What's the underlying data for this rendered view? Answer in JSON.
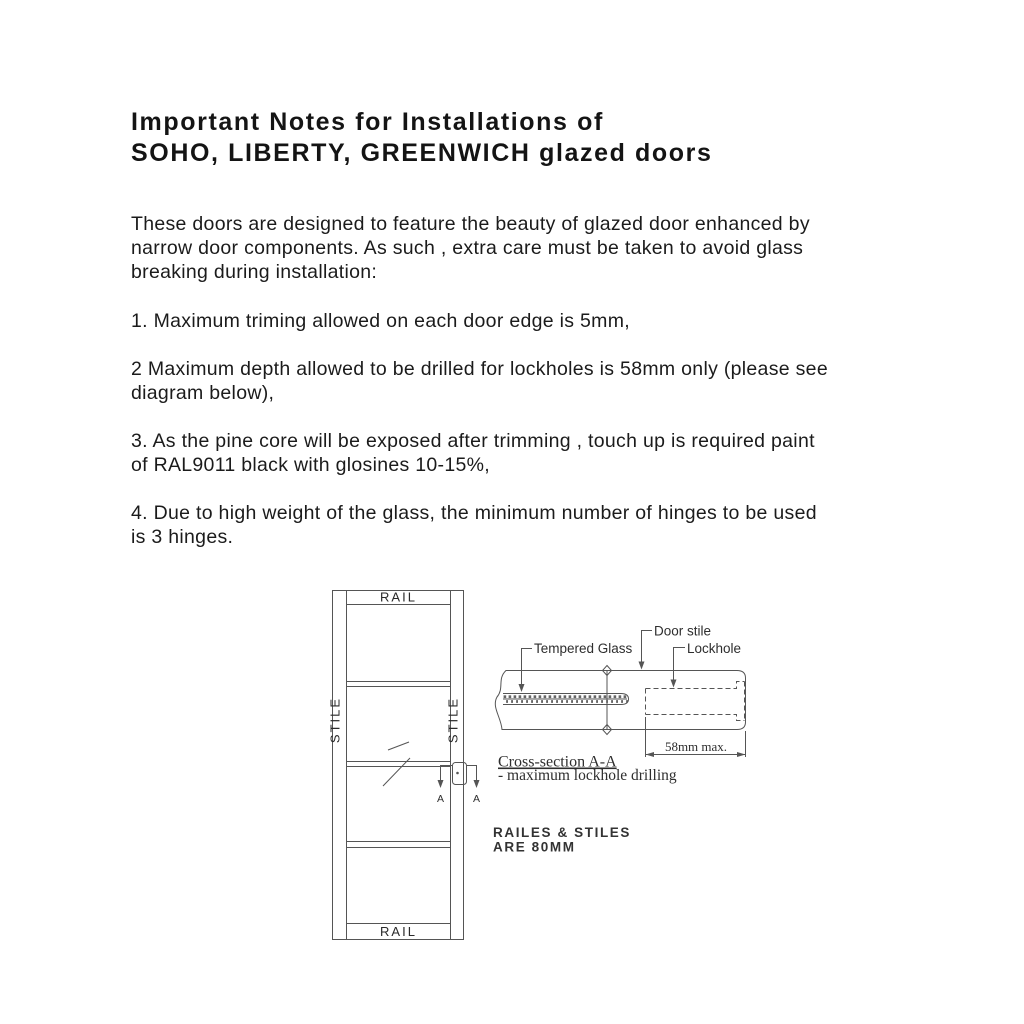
{
  "document": {
    "title_lines": [
      "Important Notes for Installations of",
      "SOHO, LIBERTY, GREENWICH glazed doors"
    ],
    "intro_lines": [
      "These doors are designed to feature the beauty of glazed door enhanced by",
      "narrow door components. As such , extra care must be taken to avoid glass",
      "breaking during installation:"
    ],
    "notes": [
      [
        "1. Maximum triming allowed on each door edge is 5mm,"
      ],
      [
        "2 Maximum depth allowed to be drilled for lockholes is 58mm only (please see",
        "diagram below),"
      ],
      [
        "3. As the pine core will be exposed after trimming , touch up is required paint",
        "of RAL9011 black with glosines 10-15%,"
      ],
      [
        "4. Due to high weight of the glass, the minimum number of hinges to be used",
        "is 3 hinges."
      ]
    ]
  },
  "diagram": {
    "door": {
      "rail_label_top": "RAIL",
      "rail_label_bottom": "RAIL",
      "stile_label_left": "STILE",
      "stile_label_right": "STILE",
      "section_label_left": "A",
      "section_label_right": "A"
    },
    "cross_section": {
      "label_tempered_glass": "Tempered Glass",
      "label_door_stile": "Door stile",
      "label_lockhole": "Lockhole",
      "dimension": "58mm max.",
      "caption": "Cross-section A-A",
      "caption_note": "- maximum lockhole drilling"
    },
    "size_note_lines": [
      "RAILES & STILES",
      "ARE 80MM"
    ]
  },
  "colors": {
    "background": "#ffffff",
    "ink": "#1b1b1b",
    "drawing_line": "#555555"
  }
}
